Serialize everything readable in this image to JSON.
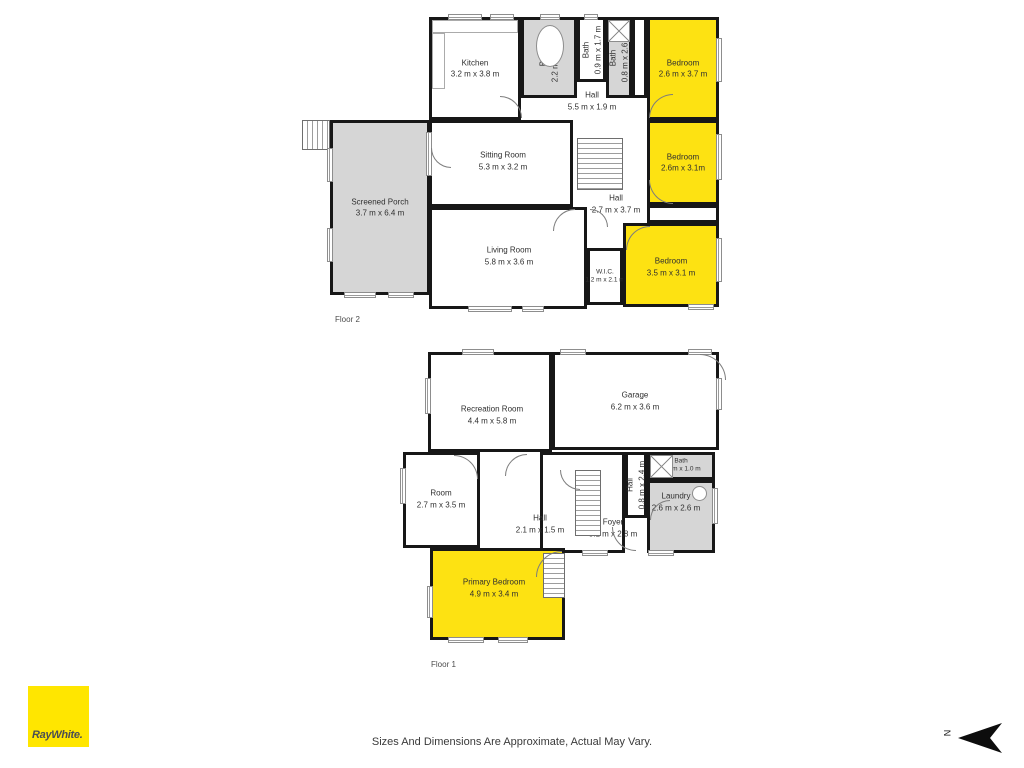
{
  "page": {
    "disclaimer": "Sizes And Dimensions Are Approximate, Actual May Vary.",
    "north_label": "N"
  },
  "logo": {
    "text": "RayWhite."
  },
  "colors": {
    "highlight_yellow": "#fde212",
    "logo_yellow": "#ffe600",
    "room_gray": "#d6d6d6",
    "wall_black": "#171717"
  },
  "floors": [
    {
      "id": "floor-2",
      "label": "Floor 2",
      "label_x": 335,
      "label_y": 315,
      "rooms": [
        {
          "name": "Screened Porch",
          "dims": "3.7 m x 6.4 m",
          "x": 330,
          "y": 120,
          "w": 100,
          "h": 175,
          "fill": "gray",
          "wall": true
        },
        {
          "name": "Kitchen",
          "dims": "3.2 m x 3.8 m",
          "x": 429,
          "y": 17,
          "w": 92,
          "h": 103,
          "fill": "white",
          "wall": true
        },
        {
          "name": "Bath",
          "dims": "2.2 m x 2.6 m",
          "x": 521,
          "y": 17,
          "w": 56,
          "h": 81,
          "fill": "gray",
          "wall": true,
          "rotate": true
        },
        {
          "name": "Bath",
          "dims": "0.9 m x 1.7 m",
          "x": 577,
          "y": 17,
          "w": 29,
          "h": 65,
          "fill": "white",
          "wall": true,
          "rotate": true
        },
        {
          "name": "Bath",
          "dims": "0.8 m x 2.6 m",
          "x": 606,
          "y": 17,
          "w": 26,
          "h": 81,
          "fill": "gray",
          "wall": true,
          "rotate": true
        },
        {
          "name": "",
          "dims": "",
          "x": 632,
          "y": 17,
          "w": 15,
          "h": 81,
          "fill": "white",
          "wall": true
        },
        {
          "name": "Bedroom",
          "dims": "2.6 m x 3.7 m",
          "x": 647,
          "y": 17,
          "w": 72,
          "h": 103,
          "fill": "yellow",
          "wall": true
        },
        {
          "name": "Hall",
          "dims": "5.5 m x 1.9 m",
          "x": 500,
          "y": 85,
          "w": 120,
          "h": 33,
          "fill": "none",
          "wall": false,
          "lx": 592,
          "ly": 101
        },
        {
          "name": "Sitting Room",
          "dims": "5.3 m x 3.2 m",
          "x": 429,
          "y": 120,
          "w": 144,
          "h": 87,
          "fill": "white",
          "wall": true,
          "lx": 503,
          "ly": 161
        },
        {
          "name": "Bedroom",
          "dims": "2.6m x 3.1m",
          "x": 647,
          "y": 120,
          "w": 72,
          "h": 85,
          "fill": "yellow",
          "wall": true
        },
        {
          "name": "Hall",
          "dims": "2.7 m x 3.7 m",
          "x": 585,
          "y": 190,
          "w": 60,
          "h": 30,
          "fill": "none",
          "wall": false,
          "lx": 616,
          "ly": 204
        },
        {
          "name": "",
          "dims": "",
          "x": 647,
          "y": 205,
          "w": 72,
          "h": 18,
          "fill": "white",
          "wall": true
        },
        {
          "name": "Living Room",
          "dims": "5.8 m x 3.6 m",
          "x": 429,
          "y": 207,
          "w": 158,
          "h": 102,
          "fill": "white",
          "wall": true,
          "lx": 509,
          "ly": 256
        },
        {
          "name": "W.I.C.",
          "dims": "1.2 m x 2.1 m",
          "x": 587,
          "y": 248,
          "w": 36,
          "h": 57,
          "fill": "white",
          "wall": true,
          "small": true
        },
        {
          "name": "Bedroom",
          "dims": "3.5 m x 3.1 m",
          "x": 623,
          "y": 223,
          "w": 96,
          "h": 84,
          "fill": "yellow",
          "wall": true,
          "lx": 671,
          "ly": 267
        }
      ],
      "stairs": [
        {
          "x": 302,
          "y": 120,
          "w": 28,
          "h": 30,
          "dir": "v"
        },
        {
          "x": 577,
          "y": 138,
          "w": 46,
          "h": 52,
          "dir": "h"
        }
      ],
      "windows": [
        {
          "x": 448,
          "y": 14,
          "w": 34,
          "h": 6
        },
        {
          "x": 490,
          "y": 14,
          "w": 24,
          "h": 6
        },
        {
          "x": 540,
          "y": 14,
          "w": 20,
          "h": 6
        },
        {
          "x": 584,
          "y": 14,
          "w": 14,
          "h": 6
        },
        {
          "x": 327,
          "y": 148,
          "w": 6,
          "h": 34
        },
        {
          "x": 327,
          "y": 228,
          "w": 6,
          "h": 34
        },
        {
          "x": 344,
          "y": 292,
          "w": 32,
          "h": 6
        },
        {
          "x": 388,
          "y": 292,
          "w": 26,
          "h": 6
        },
        {
          "x": 426,
          "y": 132,
          "w": 6,
          "h": 44
        },
        {
          "x": 468,
          "y": 306,
          "w": 44,
          "h": 6
        },
        {
          "x": 522,
          "y": 306,
          "w": 22,
          "h": 6
        },
        {
          "x": 716,
          "y": 38,
          "w": 6,
          "h": 44
        },
        {
          "x": 716,
          "y": 134,
          "w": 6,
          "h": 46
        },
        {
          "x": 716,
          "y": 238,
          "w": 6,
          "h": 44
        },
        {
          "x": 688,
          "y": 304,
          "w": 26,
          "h": 6
        }
      ],
      "doors": [
        {
          "x": 500,
          "y": 96,
          "s": 22,
          "c": "tr"
        },
        {
          "x": 649,
          "y": 94,
          "s": 24,
          "c": "tl"
        },
        {
          "x": 649,
          "y": 180,
          "s": 24,
          "c": "bl"
        },
        {
          "x": 626,
          "y": 226,
          "s": 24,
          "c": "tl"
        },
        {
          "x": 553,
          "y": 209,
          "s": 22,
          "c": "tl"
        },
        {
          "x": 431,
          "y": 148,
          "s": 20,
          "c": "bl"
        },
        {
          "x": 590,
          "y": 209,
          "s": 18,
          "c": "tr"
        }
      ],
      "fixtures": [
        {
          "type": "counter",
          "x": 432,
          "y": 20,
          "w": 86,
          "h": 13
        },
        {
          "type": "counter",
          "x": 432,
          "y": 33,
          "w": 13,
          "h": 56
        },
        {
          "type": "tub",
          "x": 536,
          "y": 25,
          "w": 28,
          "h": 42
        },
        {
          "type": "xbox",
          "x": 608,
          "y": 20,
          "w": 22,
          "h": 22
        }
      ]
    },
    {
      "id": "floor-1",
      "label": "Floor 1",
      "label_x": 431,
      "label_y": 660,
      "rooms": [
        {
          "name": "Recreation Room",
          "dims": "4.4 m x 5.8 m",
          "x": 428,
          "y": 352,
          "w": 124,
          "h": 100,
          "fill": "white",
          "wall": true,
          "lx": 492,
          "ly": 415
        },
        {
          "name": "Garage",
          "dims": "6.2 m x 3.6 m",
          "x": 552,
          "y": 352,
          "w": 167,
          "h": 98,
          "fill": "white",
          "wall": true,
          "lx": 635,
          "ly": 401
        },
        {
          "name": "Room",
          "dims": "2.7 m x 3.5 m",
          "x": 403,
          "y": 452,
          "w": 77,
          "h": 96,
          "fill": "white",
          "wall": true,
          "lx": 441,
          "ly": 499
        },
        {
          "name": "Foyer",
          "dims": "3.1 m x 2.8 m",
          "x": 540,
          "y": 452,
          "w": 85,
          "h": 101,
          "fill": "white",
          "wall": true,
          "lx": 613,
          "ly": 528
        },
        {
          "name": "Hall",
          "dims": "2.1 m x 1.5 m",
          "x": 480,
          "y": 505,
          "w": 80,
          "h": 43,
          "fill": "none",
          "wall": false,
          "lx": 540,
          "ly": 524
        },
        {
          "name": "Hall",
          "dims": "0.8 m x 2.4 m",
          "x": 625,
          "y": 452,
          "w": 22,
          "h": 66,
          "fill": "white",
          "wall": true,
          "rotate": true
        },
        {
          "name": "Bath",
          "dims": "2.5 m x 1.0 m",
          "x": 647,
          "y": 452,
          "w": 68,
          "h": 28,
          "fill": "gray",
          "wall": true,
          "small": true
        },
        {
          "name": "Laundry",
          "dims": "2.6 m x 2.6 m",
          "x": 647,
          "y": 480,
          "w": 68,
          "h": 73,
          "fill": "gray",
          "wall": true,
          "lx": 676,
          "ly": 502
        },
        {
          "name": "Primary Bedroom",
          "dims": "4.9 m x 3.4 m",
          "x": 430,
          "y": 548,
          "w": 135,
          "h": 92,
          "fill": "yellow",
          "wall": true,
          "lx": 494,
          "ly": 588
        }
      ],
      "stairs": [
        {
          "x": 575,
          "y": 470,
          "w": 26,
          "h": 66,
          "dir": "h"
        },
        {
          "x": 543,
          "y": 553,
          "w": 22,
          "h": 45,
          "dir": "h"
        }
      ],
      "windows": [
        {
          "x": 462,
          "y": 349,
          "w": 32,
          "h": 6
        },
        {
          "x": 425,
          "y": 378,
          "w": 6,
          "h": 36
        },
        {
          "x": 560,
          "y": 349,
          "w": 26,
          "h": 6
        },
        {
          "x": 688,
          "y": 349,
          "w": 24,
          "h": 6
        },
        {
          "x": 716,
          "y": 378,
          "w": 6,
          "h": 32
        },
        {
          "x": 400,
          "y": 468,
          "w": 6,
          "h": 36
        },
        {
          "x": 712,
          "y": 488,
          "w": 6,
          "h": 36
        },
        {
          "x": 448,
          "y": 637,
          "w": 36,
          "h": 6
        },
        {
          "x": 498,
          "y": 637,
          "w": 30,
          "h": 6
        },
        {
          "x": 427,
          "y": 586,
          "w": 6,
          "h": 32
        },
        {
          "x": 582,
          "y": 550,
          "w": 26,
          "h": 6
        },
        {
          "x": 648,
          "y": 550,
          "w": 26,
          "h": 6
        }
      ],
      "doors": [
        {
          "x": 700,
          "y": 354,
          "s": 26,
          "c": "tr"
        },
        {
          "x": 505,
          "y": 454,
          "s": 22,
          "c": "tl"
        },
        {
          "x": 454,
          "y": 455,
          "s": 24,
          "c": "tr"
        },
        {
          "x": 536,
          "y": 551,
          "s": 26,
          "c": "tl"
        },
        {
          "x": 612,
          "y": 527,
          "s": 24,
          "c": "bl"
        },
        {
          "x": 650,
          "y": 500,
          "s": 20,
          "c": "tl"
        },
        {
          "x": 560,
          "y": 470,
          "s": 20,
          "c": "bl"
        }
      ],
      "fixtures": [
        {
          "type": "xbox",
          "x": 650,
          "y": 455,
          "w": 23,
          "h": 23
        },
        {
          "type": "washer",
          "x": 692,
          "y": 486,
          "w": 15,
          "h": 15
        }
      ]
    }
  ]
}
